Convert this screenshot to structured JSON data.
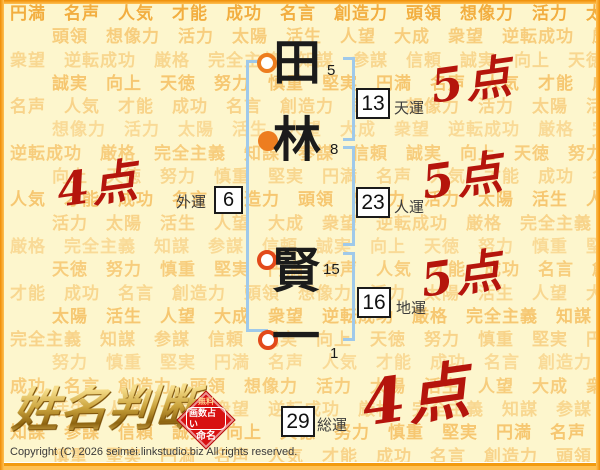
{
  "name_display": {
    "characters": [
      {
        "char": "田",
        "strokes": "5",
        "marker": "open-orange"
      },
      {
        "char": "林",
        "strokes": "8",
        "marker": "filled-orange"
      },
      {
        "char": "賢",
        "strokes": "15",
        "marker": "open-red"
      },
      {
        "char": "一",
        "strokes": "1",
        "marker": "open-red"
      }
    ]
  },
  "fortunes": [
    {
      "label": "天運",
      "value": "13",
      "score": "5点"
    },
    {
      "label": "外運",
      "value": "6",
      "score": "4点"
    },
    {
      "label": "人運",
      "value": "23",
      "score": "5点"
    },
    {
      "label": "地運",
      "value": "16",
      "score": "5点"
    },
    {
      "label": "総運",
      "value": "29",
      "score": "4点"
    }
  ],
  "logo": {
    "text": "姓名判断"
  },
  "stamp": {
    "lines": [
      "無料",
      "画数占い",
      "命名"
    ]
  },
  "footer": {
    "copyright": "Copyright (C) 2026 seimei.linkstudio.biz All rights reserved."
  },
  "background": {
    "words": [
      "円満",
      "名声",
      "人気",
      "才能",
      "成功",
      "名言",
      "創造力",
      "頭領",
      "想像力",
      "活力",
      "太陽",
      "活生",
      "人望",
      "大成",
      "衆望",
      "逆転成功",
      "厳格",
      "完全主義",
      "知謀",
      "参謀",
      "信頼",
      "誠実",
      "向上",
      "天徳",
      "努力",
      "慎重",
      "堅実"
    ]
  },
  "colors": {
    "page_bg": "#fdf6cd",
    "watermark": "#f09d1e",
    "frame_orange": "#f9a11b",
    "bracket_blue": "#9fc9ea",
    "score_red": "#b5150c",
    "marker_orange": "#ed7d1f",
    "marker_red": "#e2491a",
    "logo_gold": "#c29122",
    "stamp_red": "#d81111"
  }
}
